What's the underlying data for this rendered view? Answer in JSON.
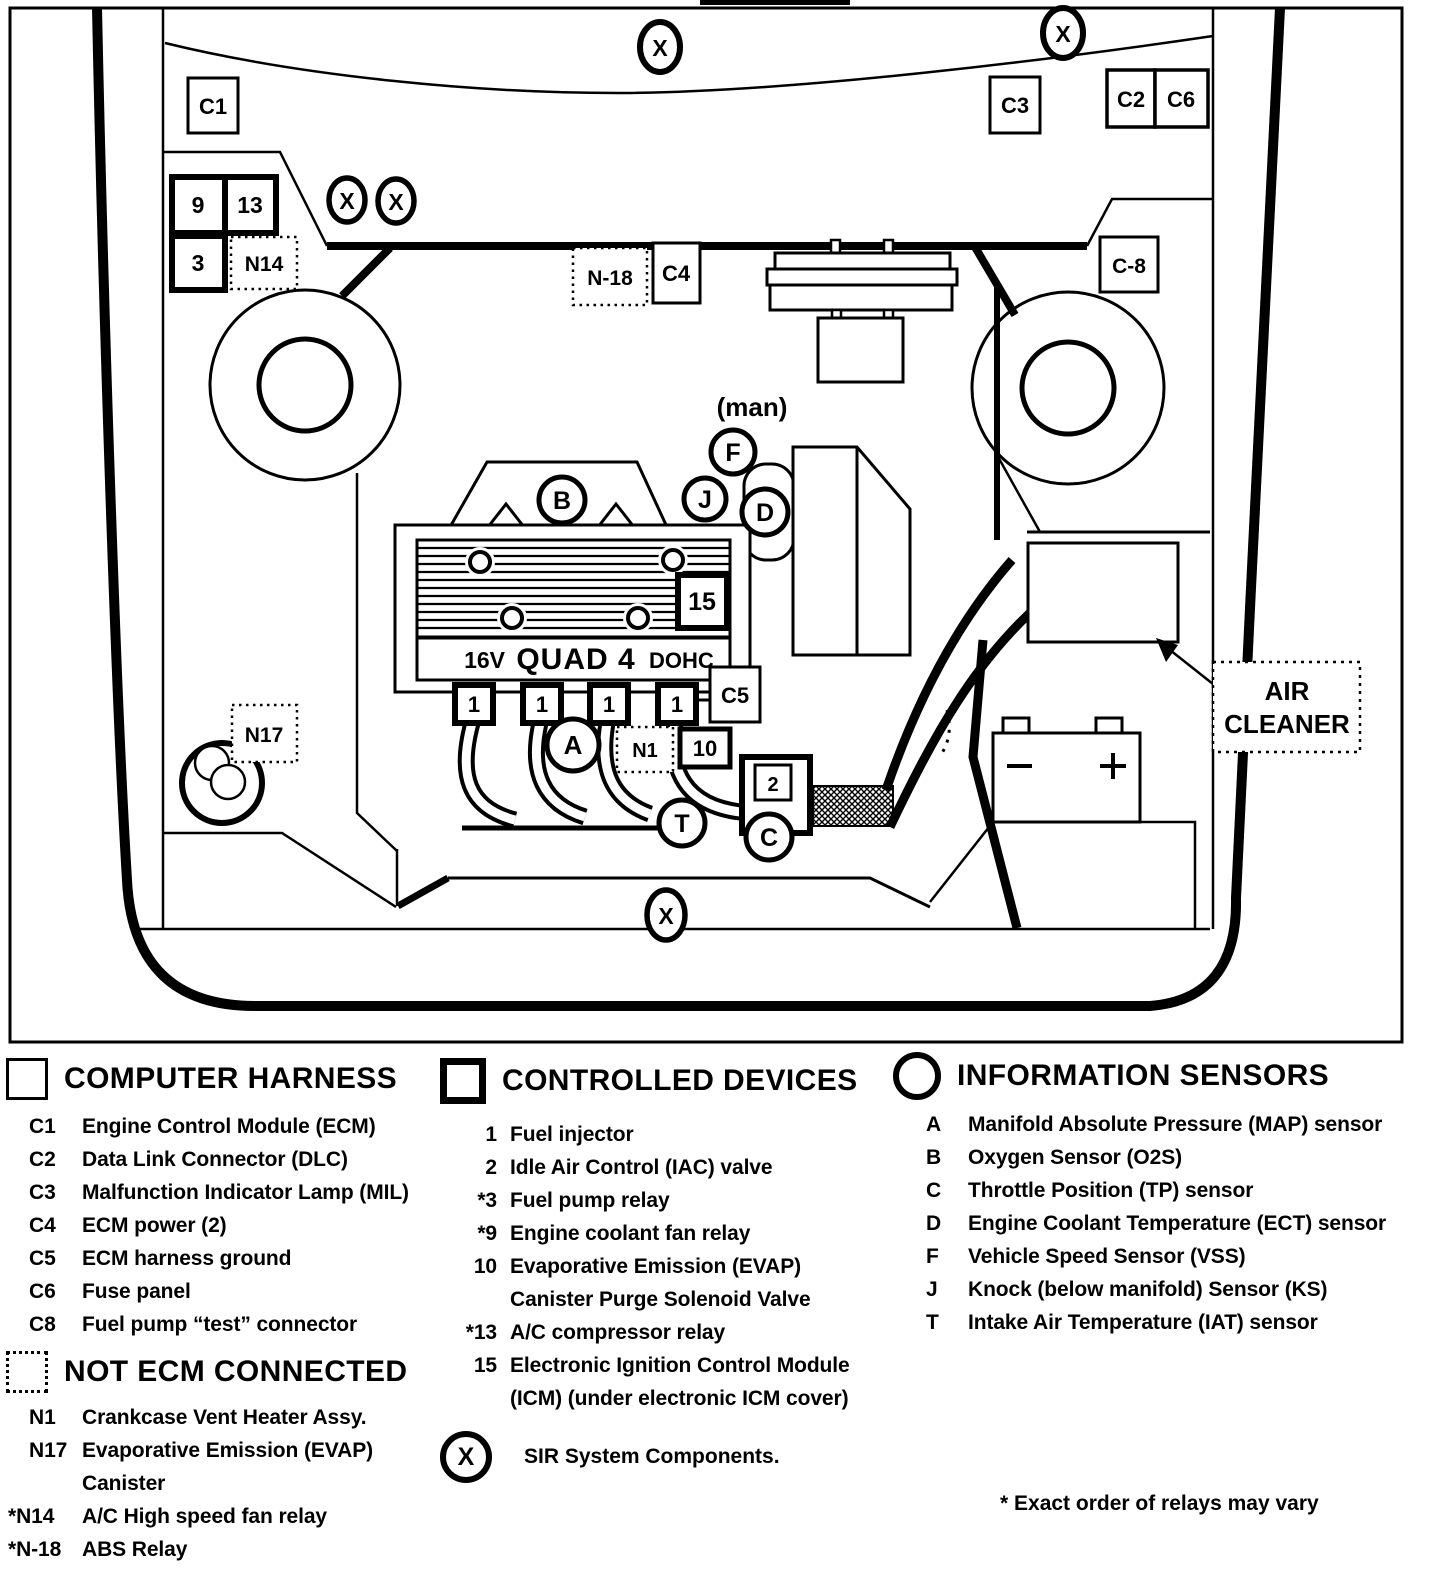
{
  "diagram": {
    "labels": {
      "c1": "C1",
      "c2": "C2",
      "c3": "C3",
      "c4": "C4",
      "c5": "C5",
      "c6": "C6",
      "c8": "C-8",
      "n1": "N1",
      "n14": "N14",
      "n17": "N17",
      "n18": "N-18",
      "r9": "9",
      "r13": "13",
      "r3": "3",
      "icm": "15",
      "evap": "10",
      "iac": "2",
      "injector": "1",
      "map": "A",
      "o2": "B",
      "tp": "C",
      "ect": "D",
      "vss": "F",
      "knock": "J",
      "iat": "T",
      "sir": "X",
      "man": "(man)"
    },
    "engine": {
      "prefix": "16V",
      "name": "QUAD 4",
      "suffix": "DOHC"
    },
    "air_cleaner": {
      "line1": "AIR",
      "line2": "CLEANER"
    }
  },
  "legend": {
    "computer_harness": {
      "title": "COMPUTER HARNESS",
      "items": [
        {
          "code": "C1",
          "label": "Engine Control Module (ECM)"
        },
        {
          "code": "C2",
          "label": "Data Link Connector (DLC)"
        },
        {
          "code": "C3",
          "label": "Malfunction Indicator Lamp (MIL)"
        },
        {
          "code": "C4",
          "label": "ECM power (2)"
        },
        {
          "code": "C5",
          "label": "ECM harness ground"
        },
        {
          "code": "C6",
          "label": "Fuse panel"
        },
        {
          "code": "C8",
          "label": "Fuel pump “test” connector"
        }
      ]
    },
    "not_ecm": {
      "title": "NOT ECM CONNECTED",
      "items": [
        {
          "code": "N1",
          "label": "Crankcase Vent Heater Assy."
        },
        {
          "code": "N17",
          "label": "Evaporative Emission (EVAP)",
          "label2": "Canister"
        },
        {
          "code": "*N14",
          "label": "A/C High speed fan relay"
        },
        {
          "code": "*N-18",
          "label": "ABS Relay"
        }
      ]
    },
    "controlled_devices": {
      "title": "CONTROLLED DEVICES",
      "items": [
        {
          "code": "1",
          "label": "Fuel injector"
        },
        {
          "code": "2",
          "label": "Idle Air Control (IAC) valve"
        },
        {
          "code": "*3",
          "label": "Fuel pump relay"
        },
        {
          "code": "*9",
          "label": "Engine coolant fan relay"
        },
        {
          "code": "10",
          "label": "Evaporative Emission (EVAP)",
          "label2": "Canister Purge Solenoid Valve"
        },
        {
          "code": "*13",
          "label": "A/C compressor relay"
        },
        {
          "code": "15",
          "label": "Electronic Ignition Control Module",
          "label2": "(ICM) (under electronic ICM cover)"
        }
      ],
      "sir_symbol": "X",
      "sir_label": "SIR System Components."
    },
    "information_sensors": {
      "title": "INFORMATION SENSORS",
      "items": [
        {
          "code": "A",
          "label": "Manifold Absolute Pressure (MAP) sensor"
        },
        {
          "code": "B",
          "label": "Oxygen Sensor (O2S)"
        },
        {
          "code": "C",
          "label": "Throttle Position (TP) sensor"
        },
        {
          "code": "D",
          "label": "Engine Coolant Temperature (ECT) sensor"
        },
        {
          "code": "F",
          "label": "Vehicle Speed Sensor (VSS)"
        },
        {
          "code": "J",
          "label": "Knock (below manifold) Sensor (KS)"
        },
        {
          "code": "T",
          "label": "Intake Air Temperature (IAT) sensor"
        }
      ]
    },
    "footnote": "* Exact order of relays may vary"
  }
}
